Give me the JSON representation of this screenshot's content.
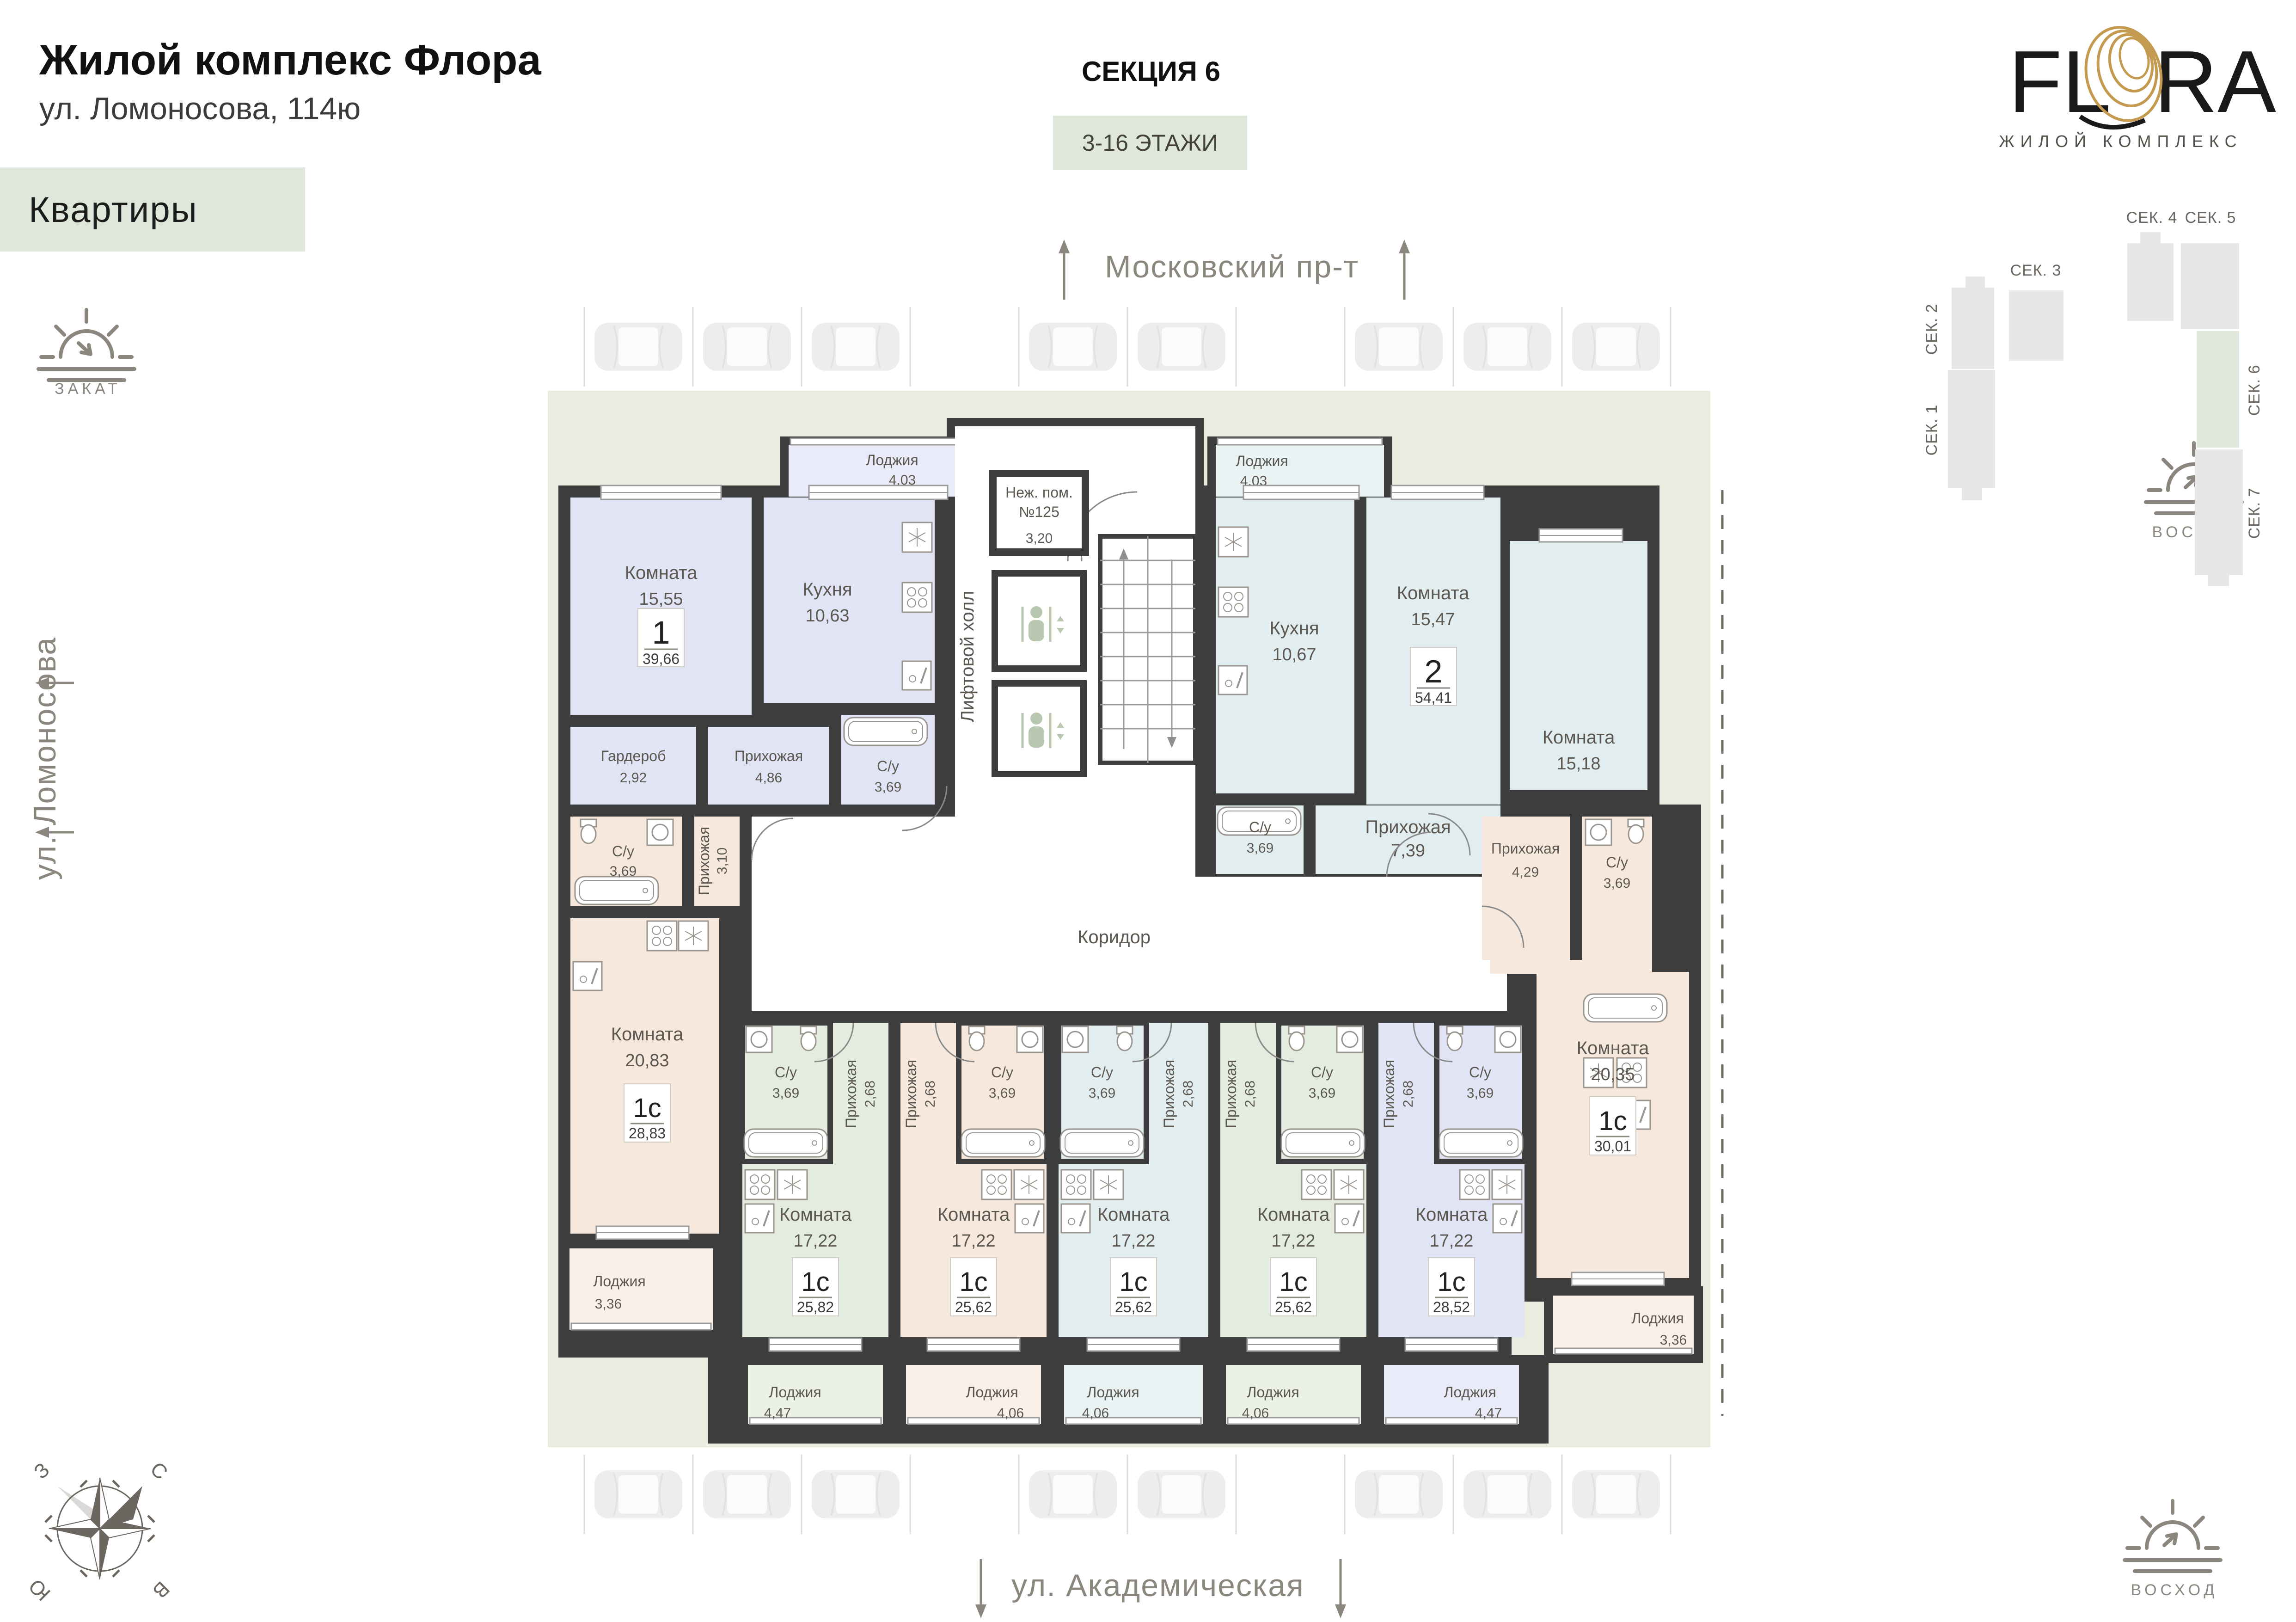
{
  "header": {
    "title": "Жилой комплекс Флора",
    "address": "ул. Ломоносова, 114ю",
    "section_title": "СЕКЦИЯ 6",
    "floors_badge": "3-16 ЭТАЖИ"
  },
  "legend": {
    "apartments_label": "Квартиры",
    "sunset_label": "ЗАКАТ",
    "sunrise_label": "ВОСХОД"
  },
  "brand": {
    "name_left": "FL",
    "name_right": "RA",
    "tagline": "ЖИЛОЙ КОМПЛЕКС"
  },
  "streets": {
    "left": "ул. Ломоносова",
    "top": "Московский пр-т",
    "bottom": "ул. Академическая"
  },
  "compass": {
    "north": "С",
    "south": "Ю",
    "west": "З",
    "east": "В"
  },
  "sitemap": {
    "sections": [
      "СЕК. 1",
      "СЕК. 2",
      "СЕК. 3",
      "СЕК. 4",
      "СЕК. 5",
      "СЕК. 6",
      "СЕК. 7"
    ]
  },
  "core": {
    "elevator_hall": "Лифтовой холл",
    "corridor": "Коридор",
    "non_residential": {
      "line1": "Неж. пом.",
      "line2": "№125",
      "area": "3,20"
    }
  },
  "apartments": [
    {
      "id": "apt-1",
      "type": "1",
      "total": "39,66",
      "rooms": [
        {
          "name": "Комната",
          "area": "15,55"
        },
        {
          "name": "Кухня",
          "area": "10,63"
        },
        {
          "name": "Гардероб",
          "area": "2,92"
        },
        {
          "name": "Прихожая",
          "area": "4,86"
        },
        {
          "name": "С/у",
          "area": "3,69"
        },
        {
          "name": "Лоджия",
          "area": "4,03"
        }
      ]
    },
    {
      "id": "apt-2",
      "type": "2",
      "total": "54,41",
      "rooms": [
        {
          "name": "Лоджия",
          "area": "4,03"
        },
        {
          "name": "Кухня",
          "area": "10,67"
        },
        {
          "name": "Комната",
          "area": "15,47"
        },
        {
          "name": "Комната",
          "area": "15,18"
        },
        {
          "name": "С/у",
          "area": "3,69"
        },
        {
          "name": "Прихожая",
          "area": "7,39"
        }
      ]
    },
    {
      "id": "apt-1c-left",
      "type": "1с",
      "total": "28,83",
      "rooms": [
        {
          "name": "С/у",
          "area": "3,69"
        },
        {
          "name": "Прихожая",
          "area": "3,10"
        },
        {
          "name": "Комната",
          "area": "20,83"
        },
        {
          "name": "Лоджия",
          "area": "3,36"
        }
      ]
    },
    {
      "id": "apt-1c-u1",
      "type": "1с",
      "total": "25,82",
      "rooms": [
        {
          "name": "С/у",
          "area": "3,69"
        },
        {
          "name": "Прихожая",
          "area": "2,68"
        },
        {
          "name": "Комната",
          "area": "17,22"
        },
        {
          "name": "Лоджия",
          "area": "4,47"
        }
      ]
    },
    {
      "id": "apt-1c-u2",
      "type": "1с",
      "total": "25,62",
      "rooms": [
        {
          "name": "С/у",
          "area": "3,69"
        },
        {
          "name": "Прихожая",
          "area": "2,68"
        },
        {
          "name": "Комната",
          "area": "17,22"
        },
        {
          "name": "Лоджия",
          "area": "4,06"
        }
      ]
    },
    {
      "id": "apt-1c-u3",
      "type": "1с",
      "total": "25,62",
      "rooms": [
        {
          "name": "С/у",
          "area": "3,69"
        },
        {
          "name": "Прихожая",
          "area": "2,68"
        },
        {
          "name": "Комната",
          "area": "17,22"
        },
        {
          "name": "Лоджия",
          "area": "4,06"
        }
      ]
    },
    {
      "id": "apt-1c-u4",
      "type": "1с",
      "total": "25,62",
      "rooms": [
        {
          "name": "С/у",
          "area": "3,69"
        },
        {
          "name": "Прихожая",
          "area": "2,68"
        },
        {
          "name": "Комната",
          "area": "17,22"
        },
        {
          "name": "Лоджия",
          "area": "4,06"
        }
      ]
    },
    {
      "id": "apt-1c-u5",
      "type": "1с",
      "total": "28,52",
      "rooms": [
        {
          "name": "С/у",
          "area": "3,69"
        },
        {
          "name": "Прихожая",
          "area": "2,68"
        },
        {
          "name": "Комната",
          "area": "17,22"
        },
        {
          "name": "Лоджия",
          "area": "4,47"
        }
      ]
    },
    {
      "id": "apt-1c-right",
      "type": "1с",
      "total": "30,01",
      "rooms": [
        {
          "name": "Прихожая",
          "area": "4,29"
        },
        {
          "name": "С/у",
          "area": "3,69"
        },
        {
          "name": "Комната",
          "area": "20,35"
        },
        {
          "name": "Лоджия",
          "area": "3,36"
        }
      ]
    }
  ]
}
